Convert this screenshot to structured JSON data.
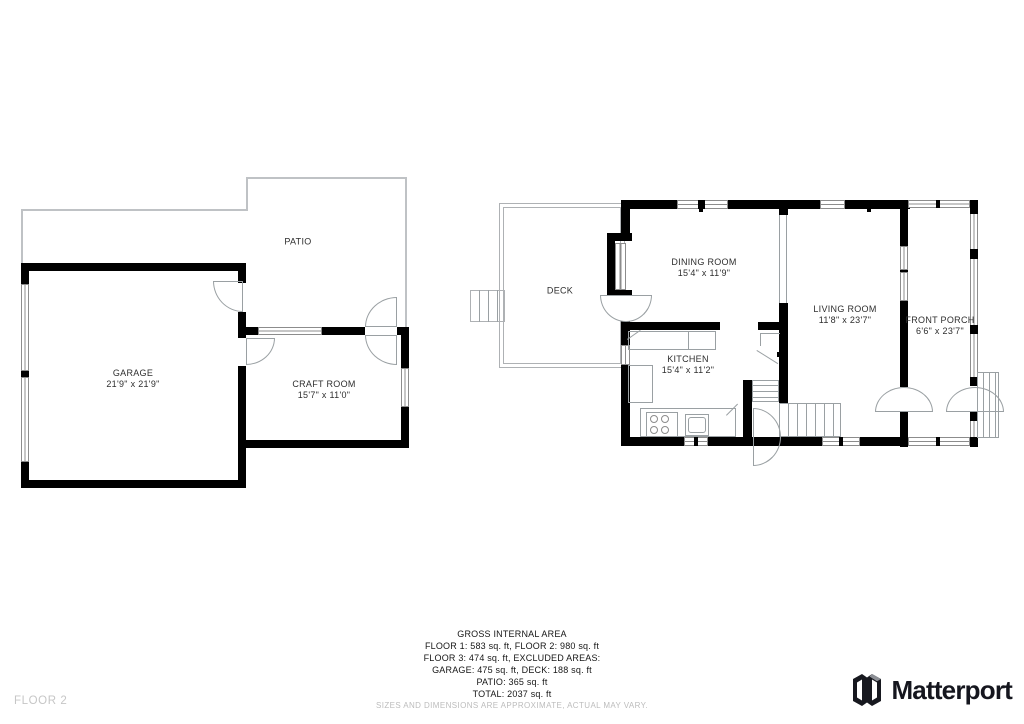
{
  "page": {
    "floor_label": "FLOOR 2"
  },
  "floor1_plan": {
    "patio": {
      "label": "PATIO"
    },
    "garage": {
      "label": "GARAGE",
      "dims": "21'9\" x 21'9\""
    },
    "craft_room": {
      "label": "CRAFT ROOM",
      "dims": "15'7\" x 11'0\""
    }
  },
  "floor2_plan": {
    "deck": {
      "label": "DECK"
    },
    "dining_room": {
      "label": "DINING ROOM",
      "dims": "15'4\" x 11'9\""
    },
    "kitchen": {
      "label": "KITCHEN",
      "dims": "15'4\" x 11'2\""
    },
    "living_room": {
      "label": "LIVING ROOM",
      "dims": "11'8\" x 23'7\""
    },
    "front_porch": {
      "label": "FRONT PORCH",
      "dims": "6'6\" x 23'7\""
    }
  },
  "summary": {
    "title": "GROSS INTERNAL AREA",
    "lines": [
      "FLOOR 1: 583 sq. ft, FLOOR 2: 980 sq. ft",
      "FLOOR 3: 474 sq. ft, EXCLUDED AREAS:",
      "GARAGE: 475 sq. ft, DECK: 188 sq. ft",
      "PATIO: 365 sq. ft",
      "TOTAL: 2037 sq. ft"
    ],
    "disclaimer": "SIZES AND DIMENSIONS ARE APPROXIMATE, ACTUAL MAY VARY."
  },
  "branding": {
    "logo_text": "Matterport",
    "logo_icon": "matterport-m-icon"
  },
  "colors": {
    "wall": "#000000",
    "thin_line": "#9aa0a3",
    "patio_outline": "#bfc2c5",
    "text": "#2e2e2e",
    "muted": "#bcbcbc",
    "logo": "#15161e"
  }
}
